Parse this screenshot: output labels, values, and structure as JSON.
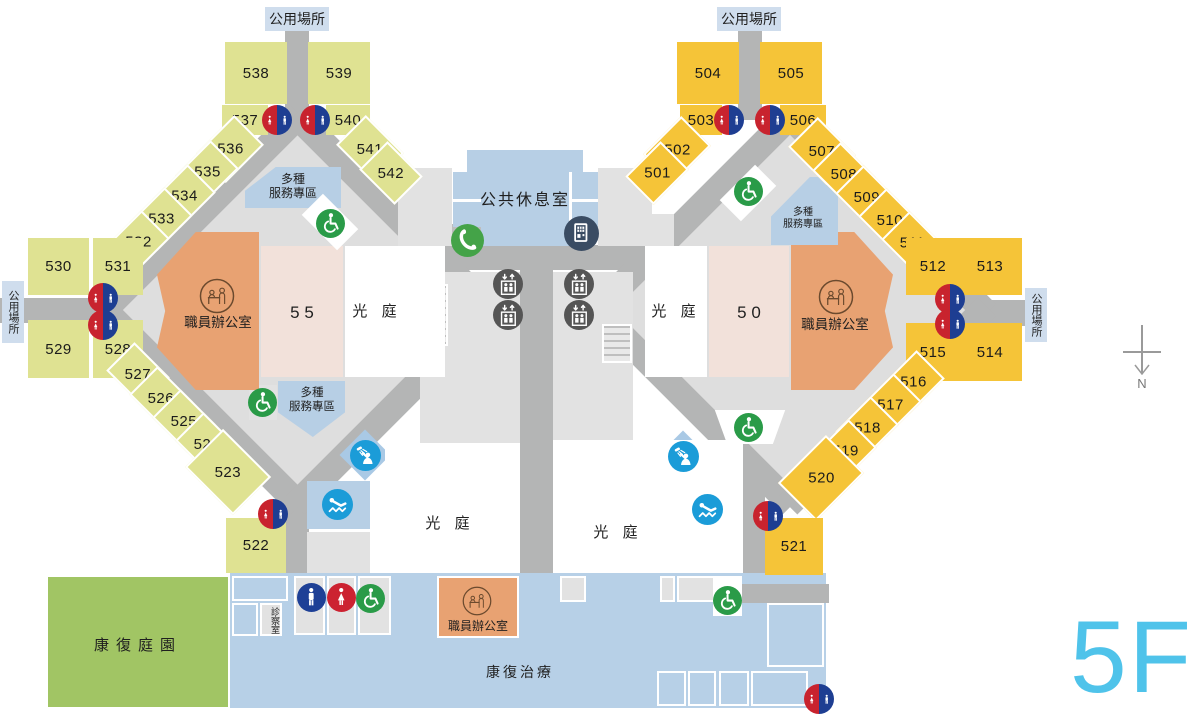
{
  "floor": {
    "tag": "5F",
    "compass": "N"
  },
  "strings": {
    "public_area": "公用場所",
    "lounge": "公共休息室",
    "court": "光 庭",
    "staff_office": "職員辦公室",
    "service_line1": "多種",
    "service_line2": "服務專區",
    "garden": "康復庭園",
    "therapy": "康復治療",
    "exam": "診察室",
    "unit_left": "5 5",
    "unit_right": "5 0"
  },
  "colors": {
    "left_shop": "#dfe292",
    "right_shop": "#f5c438",
    "office_orange": "#e8a272",
    "unit_pink": "#f2e1da",
    "service_blue": "#b7cfe5",
    "therapy_blue": "#b7d0e7",
    "garden_green": "#a1c564",
    "corridor_gray": "#b4b5b5",
    "room_gray": "#e2e2e2",
    "restroom_red": "#c8232e",
    "restroom_blue": "#1e3e92",
    "male_blue": "#1e4096",
    "female_red": "#cc2231",
    "accessible_green": "#2a9b48",
    "amenity_blue": "#1b9cd8",
    "phone_green": "#44a348",
    "vending_navy": "#3a4c63",
    "elevator_gray": "#555555",
    "floor_tag_blue": "#4fc3ea"
  },
  "rooms": {
    "left_wing": [
      {
        "num": "538",
        "x": 225,
        "y": 42,
        "w": 62,
        "h": 62,
        "rot": 0
      },
      {
        "num": "539",
        "x": 308,
        "y": 42,
        "w": 62,
        "h": 62,
        "rot": 0
      },
      {
        "num": "537",
        "x": 222,
        "y": 105,
        "w": 46,
        "h": 30,
        "rot": 0
      },
      {
        "num": "540",
        "x": 326,
        "y": 105,
        "w": 44,
        "h": 30,
        "rot": 0
      },
      {
        "num": "541",
        "x": 343,
        "y": 128,
        "w": 54,
        "h": 42,
        "rot": 45
      },
      {
        "num": "542",
        "x": 366,
        "y": 153,
        "w": 50,
        "h": 40,
        "rot": 45
      },
      {
        "num": "536",
        "x": 203,
        "y": 128,
        "w": 54,
        "h": 42,
        "rot": -45
      },
      {
        "num": "535",
        "x": 182,
        "y": 152,
        "w": 50,
        "h": 40,
        "rot": -45
      },
      {
        "num": "534",
        "x": 159,
        "y": 176,
        "w": 50,
        "h": 40,
        "rot": -45
      },
      {
        "num": "533",
        "x": 136,
        "y": 199,
        "w": 50,
        "h": 40,
        "rot": -45
      },
      {
        "num": "532",
        "x": 113,
        "y": 222,
        "w": 50,
        "h": 40,
        "rot": -45
      },
      {
        "num": "530",
        "x": 28,
        "y": 238,
        "w": 61,
        "h": 57,
        "rot": 0
      },
      {
        "num": "531",
        "x": 93,
        "y": 238,
        "w": 50,
        "h": 57,
        "rot": 0
      },
      {
        "num": "529",
        "x": 28,
        "y": 320,
        "w": 61,
        "h": 58,
        "rot": 0
      },
      {
        "num": "528",
        "x": 93,
        "y": 320,
        "w": 50,
        "h": 58,
        "rot": 0
      },
      {
        "num": "527",
        "x": 113,
        "y": 354,
        "w": 50,
        "h": 40,
        "rot": 45
      },
      {
        "num": "526",
        "x": 136,
        "y": 378,
        "w": 50,
        "h": 40,
        "rot": 45
      },
      {
        "num": "525",
        "x": 159,
        "y": 401,
        "w": 50,
        "h": 40,
        "rot": 45
      },
      {
        "num": "524",
        "x": 182,
        "y": 424,
        "w": 50,
        "h": 40,
        "rot": 45
      },
      {
        "num": "523",
        "x": 194,
        "y": 445,
        "w": 68,
        "h": 54,
        "rot": 45
      },
      {
        "num": "522",
        "x": 226,
        "y": 518,
        "w": 60,
        "h": 55,
        "rot": 0
      }
    ],
    "right_wing": [
      {
        "num": "504",
        "x": 677,
        "y": 42,
        "w": 62,
        "h": 62,
        "rot": 0
      },
      {
        "num": "505",
        "x": 760,
        "y": 42,
        "w": 62,
        "h": 62,
        "rot": 0
      },
      {
        "num": "503",
        "x": 680,
        "y": 105,
        "w": 42,
        "h": 30,
        "rot": 0
      },
      {
        "num": "506",
        "x": 780,
        "y": 105,
        "w": 46,
        "h": 30,
        "rot": 0
      },
      {
        "num": "502",
        "x": 650,
        "y": 129,
        "w": 54,
        "h": 42,
        "rot": -45
      },
      {
        "num": "501",
        "x": 632,
        "y": 153,
        "w": 50,
        "h": 40,
        "rot": -45
      },
      {
        "num": "507",
        "x": 795,
        "y": 130,
        "w": 54,
        "h": 42,
        "rot": 45
      },
      {
        "num": "508",
        "x": 819,
        "y": 154,
        "w": 50,
        "h": 40,
        "rot": 45
      },
      {
        "num": "509",
        "x": 842,
        "y": 177,
        "w": 50,
        "h": 40,
        "rot": 45
      },
      {
        "num": "510",
        "x": 865,
        "y": 200,
        "w": 50,
        "h": 40,
        "rot": 45
      },
      {
        "num": "511",
        "x": 888,
        "y": 223,
        "w": 50,
        "h": 40,
        "rot": 45
      },
      {
        "num": "512",
        "x": 906,
        "y": 238,
        "w": 54,
        "h": 57,
        "rot": 0
      },
      {
        "num": "513",
        "x": 958,
        "y": 238,
        "w": 64,
        "h": 57,
        "rot": 0
      },
      {
        "num": "515",
        "x": 906,
        "y": 323,
        "w": 54,
        "h": 58,
        "rot": 0
      },
      {
        "num": "514",
        "x": 958,
        "y": 323,
        "w": 64,
        "h": 58,
        "rot": 0
      },
      {
        "num": "516",
        "x": 888,
        "y": 362,
        "w": 50,
        "h": 40,
        "rot": -45
      },
      {
        "num": "517",
        "x": 865,
        "y": 385,
        "w": 50,
        "h": 40,
        "rot": -45
      },
      {
        "num": "518",
        "x": 842,
        "y": 408,
        "w": 50,
        "h": 40,
        "rot": -45
      },
      {
        "num": "519",
        "x": 820,
        "y": 431,
        "w": 50,
        "h": 40,
        "rot": -45
      },
      {
        "num": "520",
        "x": 787,
        "y": 451,
        "w": 68,
        "h": 54,
        "rot": -45
      },
      {
        "num": "521",
        "x": 765,
        "y": 518,
        "w": 58,
        "h": 57,
        "rot": 0
      }
    ]
  },
  "icons": [
    {
      "type": "restroom",
      "x": 277,
      "y": 120
    },
    {
      "type": "restroom",
      "x": 315,
      "y": 120
    },
    {
      "type": "restroom",
      "x": 103,
      "y": 298
    },
    {
      "type": "restroom",
      "x": 103,
      "y": 325
    },
    {
      "type": "restroom",
      "x": 273,
      "y": 514
    },
    {
      "type": "restroom",
      "x": 729,
      "y": 120
    },
    {
      "type": "restroom",
      "x": 770,
      "y": 120
    },
    {
      "type": "restroom",
      "x": 950,
      "y": 299
    },
    {
      "type": "restroom",
      "x": 950,
      "y": 324
    },
    {
      "type": "restroom",
      "x": 768,
      "y": 516
    },
    {
      "type": "restroom",
      "x": 819,
      "y": 699
    },
    {
      "type": "male",
      "x": 311,
      "y": 597
    },
    {
      "type": "female",
      "x": 341,
      "y": 597
    },
    {
      "type": "accessible",
      "x": 370,
      "y": 598
    },
    {
      "type": "accessible",
      "x": 330,
      "y": 223
    },
    {
      "type": "accessible",
      "x": 262,
      "y": 402
    },
    {
      "type": "accessible",
      "x": 748,
      "y": 191
    },
    {
      "type": "accessible",
      "x": 748,
      "y": 427
    },
    {
      "type": "accessible",
      "x": 727,
      "y": 600
    },
    {
      "type": "shower",
      "x": 365,
      "y": 455
    },
    {
      "type": "shower",
      "x": 683,
      "y": 456
    },
    {
      "type": "recline",
      "x": 337,
      "y": 504
    },
    {
      "type": "recline",
      "x": 707,
      "y": 509
    },
    {
      "type": "phone",
      "x": 467,
      "y": 240
    },
    {
      "type": "vending",
      "x": 581,
      "y": 233
    },
    {
      "type": "elevator",
      "x": 508,
      "y": 284
    },
    {
      "type": "elevator",
      "x": 508,
      "y": 315
    },
    {
      "type": "elevator",
      "x": 579,
      "y": 284
    },
    {
      "type": "elevator",
      "x": 579,
      "y": 315
    },
    {
      "type": "reception",
      "x": 217,
      "y": 296,
      "d": 36
    },
    {
      "type": "reception",
      "x": 836,
      "y": 297,
      "d": 36
    },
    {
      "type": "reception",
      "x": 477,
      "y": 601,
      "d": 30
    }
  ]
}
